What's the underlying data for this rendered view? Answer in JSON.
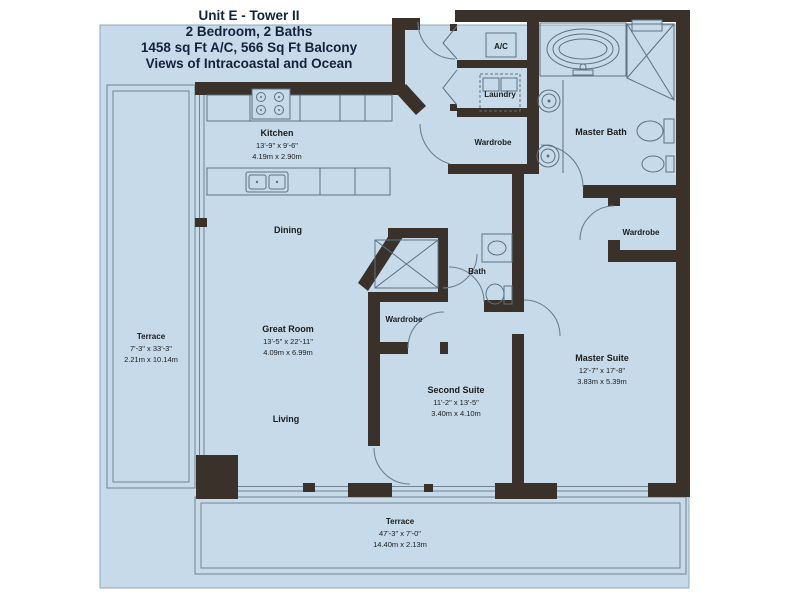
{
  "title": {
    "line1": "Unit E - Tower II",
    "line2": "2 Bedroom, 2 Baths",
    "line3": "1458 sq Ft A/C, 566 Sq Ft Balcony",
    "line4": "Views of Intracoastal and Ocean"
  },
  "rooms": {
    "kitchen": {
      "label": "Kitchen",
      "size_ft": "13'-9\" x 9'-6\"",
      "size_m": "4.19m x 2.90m"
    },
    "dining": {
      "label": "Dining"
    },
    "great_room": {
      "label": "Great Room",
      "size_ft": "13'-5\" x 22'-11\"",
      "size_m": "4.09m x 6.99m"
    },
    "living": {
      "label": "Living"
    },
    "second_suite": {
      "label": "Second Suite",
      "size_ft": "11'-2\" x 13'-5\"",
      "size_m": "3.40m x 4.10m"
    },
    "master_suite": {
      "label": "Master Suite",
      "size_ft": "12'-7\" x 17'-8\"",
      "size_m": "3.83m x 5.39m"
    },
    "master_bath": {
      "label": "Master Bath"
    },
    "bath": {
      "label": "Bath"
    },
    "wardrobe_entry": {
      "label": "Wardrobe"
    },
    "wardrobe_second": {
      "label": "Wardrobe"
    },
    "wardrobe_master": {
      "label": "Wardrobe"
    },
    "ac": {
      "label": "A/C"
    },
    "laundry": {
      "label": "Laundry"
    },
    "terrace_side": {
      "label": "Terrace",
      "size_ft": "7'-3\" x 33'-3\"",
      "size_m": "2.21m x 10.14m"
    },
    "terrace_bottom": {
      "label": "Terrace",
      "size_ft": "47'-3\" x 7'-0\"",
      "size_m": "14.40m x 2.13m"
    }
  },
  "colors": {
    "plan_background": "#c6dae9",
    "walls": "#3a322a",
    "fixture_lines": "#5c7183",
    "title_text": "#16213c",
    "label_text": "#1c1c1c"
  }
}
